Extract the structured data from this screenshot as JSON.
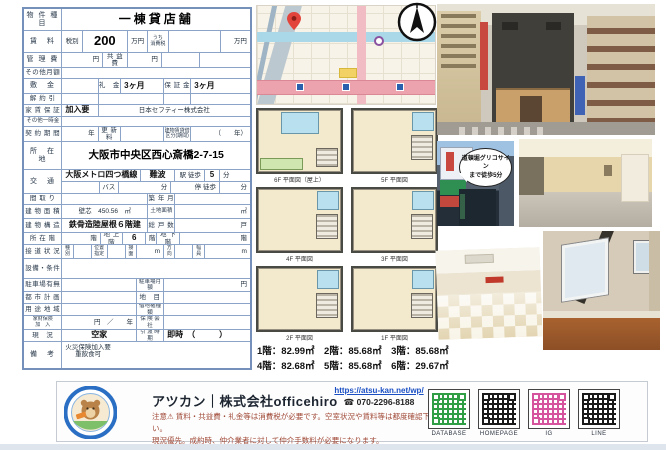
{
  "table": {
    "rows": [
      {
        "h": 22,
        "cells": [
          {
            "t": "物 件 種 目",
            "w": 17,
            "c": "lbl"
          },
          {
            "t": "一棟貸店舗",
            "w": 83,
            "c": "title"
          }
        ]
      },
      {
        "h": 22,
        "cells": [
          {
            "t": "賃　料",
            "w": 17,
            "c": "lbl"
          },
          {
            "t": "税別",
            "w": 9,
            "c": "sm"
          },
          {
            "t": "200",
            "w": 20,
            "c": "big"
          },
          {
            "t": "万円",
            "w": 9,
            "c": "sm"
          },
          {
            "t": "うち\n消費税",
            "w": 9,
            "c": "tiny2"
          },
          {
            "t": "",
            "w": 23
          },
          {
            "t": "万円",
            "w": 13,
            "c": "sm right"
          }
        ]
      },
      {
        "h": 15,
        "cells": [
          {
            "t": "管 理 費",
            "w": 17,
            "c": "lbl"
          },
          {
            "t": "円",
            "w": 18,
            "c": "sm right"
          },
          {
            "t": "共 益 費",
            "w": 11,
            "c": "lbl2"
          },
          {
            "t": "円",
            "w": 15,
            "c": "sm right"
          },
          {
            "t": "",
            "w": 17
          },
          {
            "t": "",
            "w": 22
          }
        ]
      },
      {
        "h": 11,
        "cells": [
          {
            "t": "その他月額",
            "w": 17,
            "c": "lbl2"
          },
          {
            "t": "",
            "w": 83
          }
        ]
      },
      {
        "h": 15,
        "cells": [
          {
            "t": "敷　金",
            "w": 17,
            "c": "lbl"
          },
          {
            "t": "",
            "w": 16
          },
          {
            "t": "礼　金",
            "w": 10,
            "c": "lbl2"
          },
          {
            "t": "3ヶ月",
            "w": 19,
            "c": "val left"
          },
          {
            "t": "保 証 金",
            "w": 12,
            "c": "lbl2"
          },
          {
            "t": "3ヶ月",
            "w": 26,
            "c": "val left"
          }
        ]
      },
      {
        "h": 11,
        "cells": [
          {
            "t": "解 約 引",
            "w": 17,
            "c": "lbl2"
          },
          {
            "t": "",
            "w": 16
          },
          {
            "t": "",
            "w": 29
          },
          {
            "t": "",
            "w": 12
          },
          {
            "t": "",
            "w": 26
          }
        ]
      },
      {
        "h": 12,
        "cells": [
          {
            "t": "家 賃 保 証",
            "w": 17,
            "c": "lbl2"
          },
          {
            "t": "加入要",
            "w": 16,
            "c": "val left"
          },
          {
            "t": "日本セフティー株式会社",
            "w": 67,
            "c": "sm"
          }
        ]
      },
      {
        "h": 10,
        "cells": [
          {
            "t": "その他一時金",
            "w": 17,
            "c": "tiny"
          },
          {
            "t": "",
            "w": 83
          }
        ]
      },
      {
        "h": 15,
        "cells": [
          {
            "t": "契 約 期 間",
            "w": 17,
            "c": "lbl2"
          },
          {
            "t": "年",
            "w": 16,
            "c": "sm right"
          },
          {
            "t": "更 新 料",
            "w": 10,
            "c": "lbl2"
          },
          {
            "t": "",
            "w": 19
          },
          {
            "t": "建物賃貸借\n区分(期間)",
            "w": 12,
            "c": "tiny2"
          },
          {
            "t": "（　　年）",
            "w": 26,
            "c": "sm right"
          }
        ]
      },
      {
        "h": 28,
        "cells": [
          {
            "t": "所　在　地",
            "w": 17,
            "c": "lbl"
          },
          {
            "t": "大阪市中央区西心斎橋2-7-15",
            "w": 83,
            "c": "addr"
          }
        ]
      },
      {
        "h": 24,
        "cells": [
          {
            "t": "交　通",
            "w": 17,
            "c": "lbl"
          },
          {
            "w": 83,
            "rows": [
              {
                "cells": [
                  {
                    "t": "大阪メトロ四つ橋線",
                    "w": 42,
                    "c": "val left"
                  },
                  {
                    "t": "難波",
                    "w": 18,
                    "c": "val"
                  },
                  {
                    "t": "駅 徒歩",
                    "w": 16,
                    "c": "sm right"
                  },
                  {
                    "t": "5",
                    "w": 8,
                    "c": "val"
                  },
                  {
                    "t": "分",
                    "w": 16,
                    "c": "sm left"
                  }
                ]
              },
              {
                "cells": [
                  {
                    "t": "",
                    "w": 20
                  },
                  {
                    "t": "バス",
                    "w": 10,
                    "c": "sm"
                  },
                  {
                    "t": "分",
                    "w": 28,
                    "c": "sm right"
                  },
                  {
                    "t": "停 徒歩",
                    "w": 26,
                    "c": "sm right"
                  },
                  {
                    "t": "分",
                    "w": 16,
                    "c": "sm right"
                  }
                ]
              }
            ]
          }
        ]
      },
      {
        "h": 11,
        "cells": [
          {
            "t": "間 取 り",
            "w": 17,
            "c": "lbl2"
          },
          {
            "t": "",
            "w": 38
          },
          {
            "t": "築 年 月",
            "w": 12,
            "c": "lbl2"
          },
          {
            "t": "",
            "w": 33
          }
        ]
      },
      {
        "h": 14,
        "cells": [
          {
            "t": "建 物 面 積",
            "w": 17,
            "c": "lbl2"
          },
          {
            "t": "壁芯　450.56　㎡",
            "w": 38,
            "c": "sm"
          },
          {
            "t": "土地面積",
            "w": 12,
            "c": "tiny"
          },
          {
            "t": "㎡",
            "w": 33,
            "c": "sm right"
          }
        ]
      },
      {
        "h": 14,
        "cells": [
          {
            "t": "建 物 構 造",
            "w": 17,
            "c": "lbl2"
          },
          {
            "t": "鉄骨造陸屋根６階建",
            "w": 38,
            "c": "val"
          },
          {
            "t": "総 戸 数",
            "w": 12,
            "c": "lbl2"
          },
          {
            "t": "戸",
            "w": 33,
            "c": "sm right"
          }
        ]
      },
      {
        "h": 12,
        "cells": [
          {
            "t": "所 在 階",
            "w": 17,
            "c": "lbl2"
          },
          {
            "t": "階",
            "w": 17,
            "c": "sm right"
          },
          {
            "t": "地 上 階",
            "w": 10,
            "c": "lbl2"
          },
          {
            "t": "6",
            "w": 10,
            "c": "val"
          },
          {
            "t": "階",
            "w": 5,
            "c": "sm left"
          },
          {
            "t": "地 下 階",
            "w": 10,
            "c": "lbl2"
          },
          {
            "t": "階",
            "w": 31,
            "c": "sm right"
          }
        ]
      },
      {
        "h": 14,
        "cells": [
          {
            "t": "接 道 状 況",
            "w": 17,
            "c": "lbl2"
          },
          {
            "t": "種\n別",
            "w": 5,
            "c": "tiny2"
          },
          {
            "t": "",
            "w": 8
          },
          {
            "t": "位置\n指定",
            "w": 7,
            "c": "tiny2"
          },
          {
            "t": "",
            "w": 8
          },
          {
            "t": "接\n面",
            "w": 5,
            "c": "tiny2"
          },
          {
            "t": "m",
            "w": 12,
            "c": "sm right"
          },
          {
            "t": "方\n向",
            "w": 5,
            "c": "tiny2"
          },
          {
            "t": "",
            "w": 8
          },
          {
            "t": "幅\n員",
            "w": 5,
            "c": "tiny2"
          },
          {
            "t": "m",
            "w": 20,
            "c": "sm right"
          }
        ]
      },
      {
        "h": 20,
        "cells": [
          {
            "t": "設備・条件",
            "w": 17,
            "c": "lbl2"
          },
          {
            "t": "",
            "w": 83
          }
        ]
      },
      {
        "h": 13,
        "cells": [
          {
            "t": "駐車場有無",
            "w": 17,
            "c": "lbl2"
          },
          {
            "t": "",
            "w": 33
          },
          {
            "t": "駐車場月額",
            "w": 12,
            "c": "tiny"
          },
          {
            "t": "円",
            "w": 38,
            "c": "sm right"
          }
        ]
      },
      {
        "h": 12,
        "cells": [
          {
            "t": "都 市 計 画",
            "w": 17,
            "c": "lbl2"
          },
          {
            "t": "",
            "w": 33
          },
          {
            "t": "地　目",
            "w": 12,
            "c": "lbl2"
          },
          {
            "t": "",
            "w": 38
          }
        ]
      },
      {
        "h": 12,
        "cells": [
          {
            "t": "用 途 地 域",
            "w": 17,
            "c": "lbl2"
          },
          {
            "t": "",
            "w": 33
          },
          {
            "t": "借地権種類",
            "w": 12,
            "c": "tiny"
          },
          {
            "t": "",
            "w": 38
          }
        ]
      },
      {
        "h": 14,
        "cells": [
          {
            "t": "家財保険\n加　入",
            "w": 17,
            "c": "tiny2"
          },
          {
            "t": "円　／　　年",
            "w": 33,
            "c": "sm right"
          },
          {
            "t": "保 険 会 社",
            "w": 12,
            "c": "tiny"
          },
          {
            "t": "",
            "w": 38
          }
        ]
      },
      {
        "h": 12,
        "cells": [
          {
            "t": "現　況",
            "w": 17,
            "c": "lbl2"
          },
          {
            "t": "空家",
            "w": 33,
            "c": "val"
          },
          {
            "t": "引 渡 時 期",
            "w": 12,
            "c": "tiny"
          },
          {
            "t": "即時　（　　　）",
            "w": 38,
            "c": "val left"
          }
        ]
      },
      {
        "h": 26,
        "cells": [
          {
            "t": "備　考",
            "w": 17,
            "c": "lbl"
          },
          {
            "t": "火災保険加入要\n重飲食可",
            "w": 83,
            "c": "sm left top"
          }
        ]
      }
    ]
  },
  "floorplans": {
    "captions": [
      "6F 平面図（屋上）",
      "5F 平面図",
      "4F 平面図",
      "3F 平面図",
      "2F 平面図",
      "1F 平面図"
    ],
    "areas_line1": "1階：82.99㎡　2階：85.68㎡　3階：85.68㎡",
    "areas_line2": "4階：82.68㎡　5階：85.68㎡　6階：29.67㎡"
  },
  "photos": {
    "bubble_line1": "道頓堀グリコサイン",
    "bubble_line2": "まで徒歩5分"
  },
  "footer": {
    "brand": "アツカン｜株式会社officehiro",
    "url": "https://atsu-kan.net/wp/",
    "phone_icon": "☎",
    "phone": "070-2296-8188",
    "note1": "注意⚠ 賃料・共益費・礼金等は消費税が必要です。空室状況や賃料等は都度確認下さい。",
    "note2": "現況優先。成約時、仲介業者に対して仲介手数料が必要になります。",
    "qr": [
      {
        "label": "DATABASE",
        "color": "#2f9e44"
      },
      {
        "label": "HOMEPAGE",
        "color": "#1a1a1a"
      },
      {
        "label": "IG",
        "color": "#d6549e"
      },
      {
        "label": "LINE",
        "color": "#1a1a1a"
      }
    ]
  },
  "colors": {
    "table_border": "#7590ba",
    "note_text": "#a14a38",
    "map_pin": "#e2443b"
  }
}
